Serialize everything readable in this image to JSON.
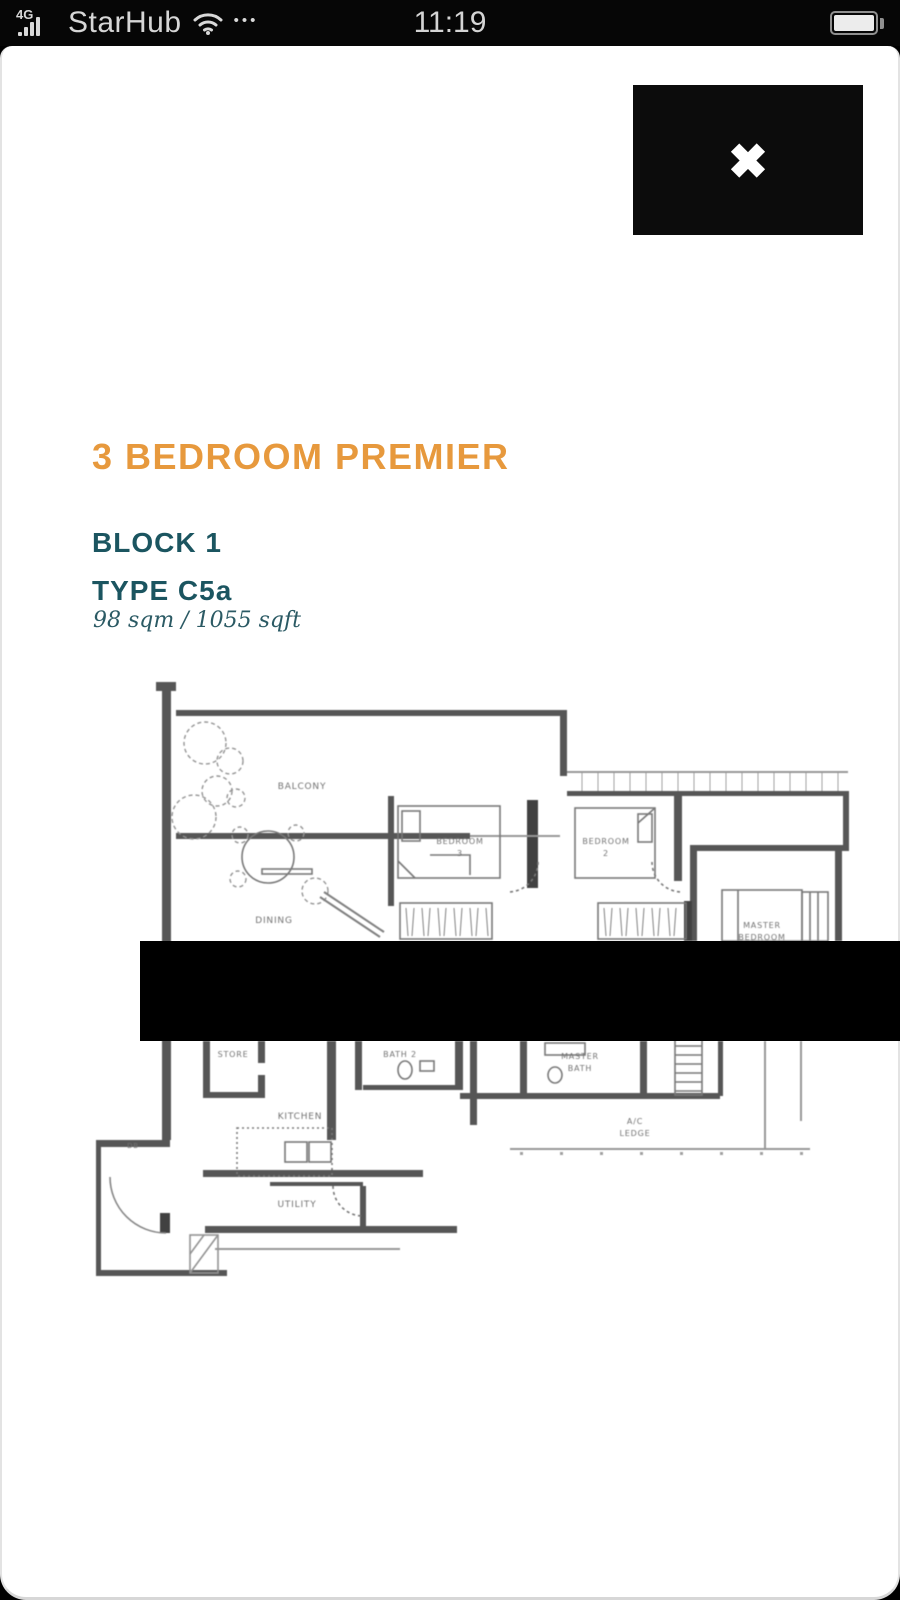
{
  "status_bar": {
    "network": "4G",
    "carrier": "StarHub",
    "more": "•••",
    "time": "11:19"
  },
  "overlay": {
    "close": "✖"
  },
  "listing": {
    "title": "3 BEDROOM PREMIER",
    "block": "BLOCK 1",
    "unit_type": "TYPE C5a",
    "area": "98 sqm / 1055 sqft"
  },
  "floorplan": {
    "labels": {
      "balcony": "BALCONY",
      "dining": "DINING",
      "bedroom3_line1": "BEDROOM",
      "bedroom3_line2": "3",
      "bedroom2_line1": "BEDROOM",
      "bedroom2_line2": "2",
      "master_line1": "MASTER",
      "master_line2": "BEDROOM",
      "store": "STORE",
      "bath2": "BATH 2",
      "master_bath_line1": "MASTER",
      "master_bath_line2": "BATH",
      "kitchen": "KITCHEN",
      "ac_line1": "A/C",
      "ac_line2": "LEDGE",
      "utility": "UTILITY",
      "db": "DB"
    }
  },
  "colors": {
    "accent_orange": "#E7993D",
    "teal": "#1B5560",
    "redaction": "#000000"
  }
}
